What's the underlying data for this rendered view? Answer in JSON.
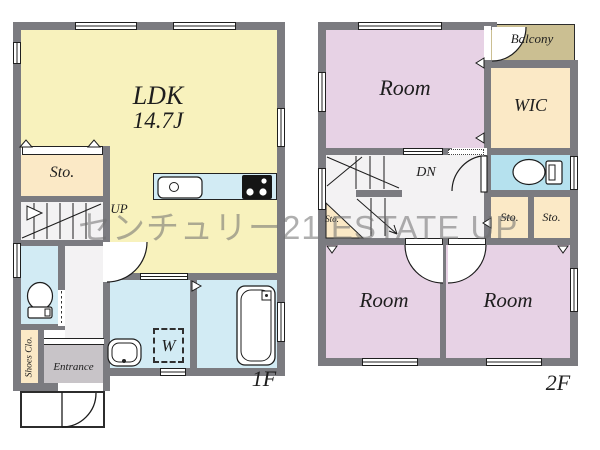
{
  "watermark_text": "センチュリー21 ESTATE UP",
  "floor1": {
    "floor_label": "1F",
    "ldk": {
      "name": "LDK",
      "size": "14.7J"
    },
    "storage_label": "Sto.",
    "stairs_label": "UP",
    "shoes_closet_label": "Shoes Clo.",
    "entrance_label": "Entrance",
    "washer_label": "W"
  },
  "floor2": {
    "floor_label": "2F",
    "room_top_label": "Room",
    "room_left_label": "Room",
    "room_right_label": "Room",
    "balcony_label": "Balcony",
    "wic_label": "WIC",
    "stairs_label": "DN",
    "storage_under_stairs_label": "Sto.",
    "storage_left_label": "Sto.",
    "storage_right_label": "Sto."
  },
  "colors": {
    "wall_gray": "#7b7b80",
    "ldk_yellow": "#f8f2bd",
    "room_pink": "#e7d2e5",
    "storage_cream": "#fbe9c6",
    "water_cyan": "#d2ebf4",
    "toilet_blue": "#b5e1ee",
    "balcony_khaki": "#cbbf92",
    "entrance_gray": "#c8c4c8",
    "hall_gray": "#f3f2f3",
    "watermark_gray": "#6e6e6e"
  }
}
